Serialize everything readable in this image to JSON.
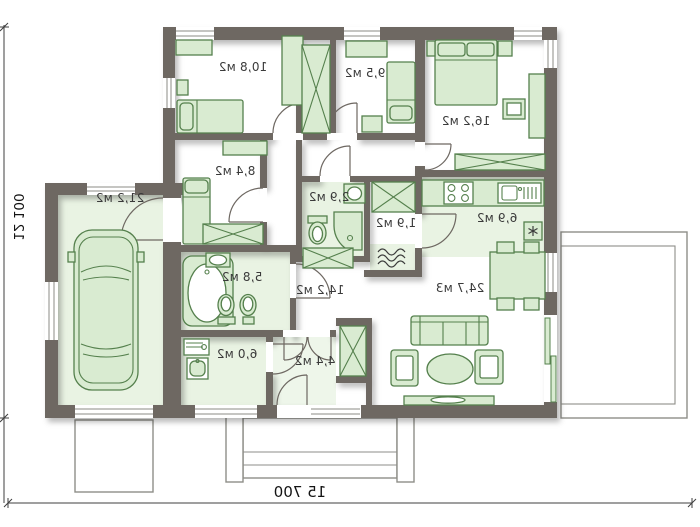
{
  "plan": {
    "rooms": [
      {
        "id": "bedroom-1",
        "area": "10,8 м2"
      },
      {
        "id": "bedroom-2",
        "area": "9,5 м2"
      },
      {
        "id": "bedroom-master",
        "area": "16,2 м2"
      },
      {
        "id": "cabinet",
        "area": "8,4 м2"
      },
      {
        "id": "garage",
        "area": "21,2 м2"
      },
      {
        "id": "wc",
        "area": "2,9 м2"
      },
      {
        "id": "storage",
        "area": "1,9 м2"
      },
      {
        "id": "kitchen",
        "area": "6,9 м2"
      },
      {
        "id": "bathroom",
        "area": "5,8 м2"
      },
      {
        "id": "hallway",
        "area": "14,2 м2"
      },
      {
        "id": "living-room",
        "area": "24,7 м3"
      },
      {
        "id": "utility",
        "area": "6,0 м2"
      },
      {
        "id": "entry",
        "area": "4,4 м2"
      }
    ],
    "dimensions": {
      "overall_width": "15 700",
      "overall_depth": "12 100"
    },
    "colors": {
      "wall": "#6e6862",
      "furniture_fill": "#d9ebd1",
      "furniture_stroke": "#55804d",
      "floor_tint": "#e9f3e3",
      "background": "#ffffff"
    }
  }
}
